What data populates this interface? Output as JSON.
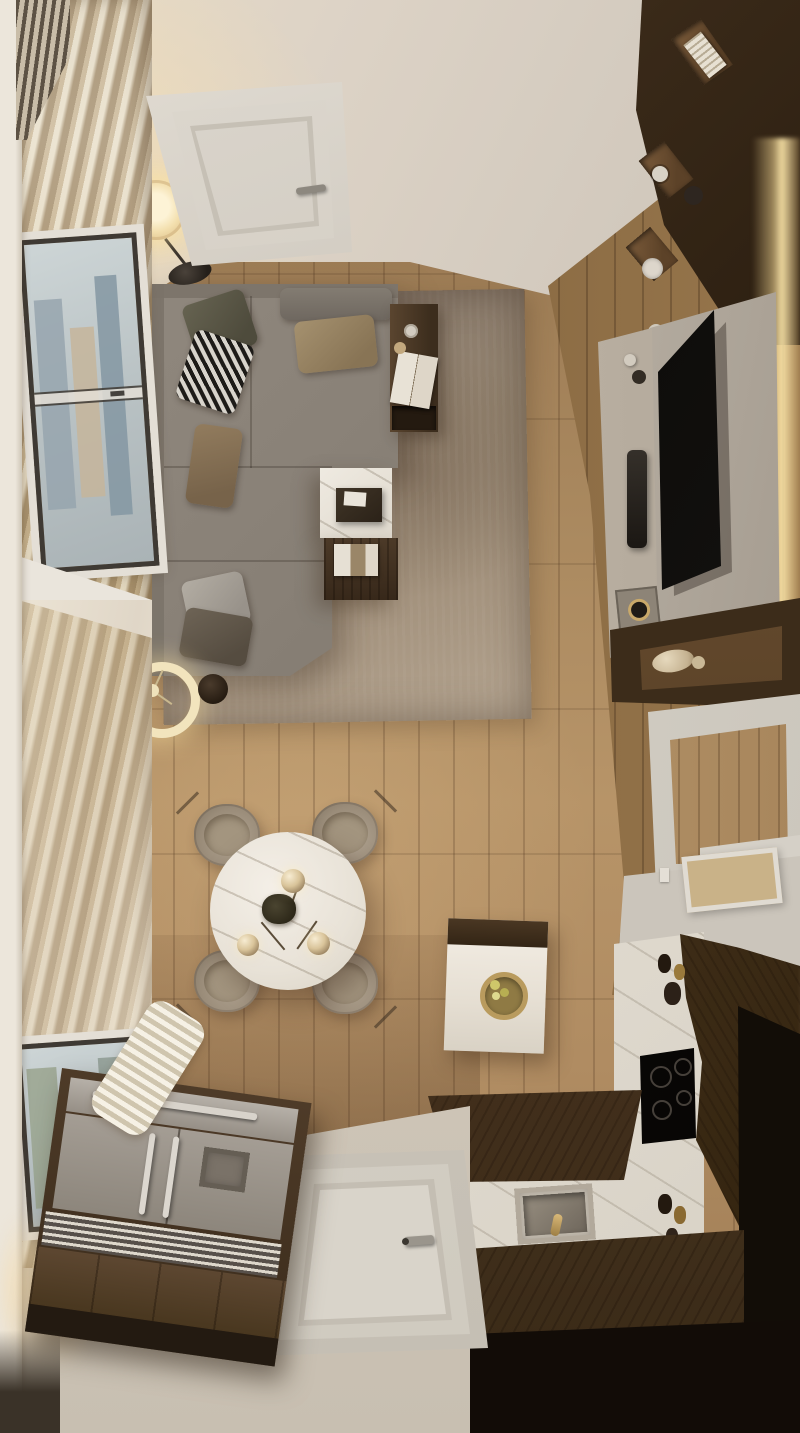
{
  "meta": {
    "domain": "natural-image",
    "subject": "Top-down 3D render of a small apartment: living room with L-shaped sofa, TV wall, round dining table, and walnut-and-marble kitchen",
    "visible_text": []
  },
  "palette": {
    "ceiling": "#d8cfc4",
    "floor-mid": "#a8855c",
    "rug": "#9c8b7a",
    "sofa": "#8a8278",
    "walnut": "#4f3b29",
    "walnut-dark": "#33261a",
    "marble": "#ece7df",
    "tv-black": "#0c0b09",
    "led-glow": "#f3ddad",
    "curtain": "#cbb795",
    "white-door": "#dad5cd",
    "entry-floor": "#cec7bb",
    "steel": "#a49d94",
    "chair": "#a79a8a",
    "gold": "#c9a96a",
    "window-view": "#b9c2c4"
  },
  "scene": {
    "areas": [
      {
        "name": "living-area",
        "objects": [
          "l-shaped-sofa",
          "throw-pillows",
          "area-rug",
          "marble-coffee-table",
          "wood-coffee-table",
          "side-table",
          "floor-lamp",
          "ring-table-lamp"
        ]
      },
      {
        "name": "tv-wall",
        "objects": [
          "bookshelf-cubbies",
          "stone-tv-panel",
          "wall-mounted-tv",
          "soundbar",
          "media-console",
          "floating-shelf",
          "vases",
          "led-strip"
        ]
      },
      {
        "name": "dining-area",
        "objects": [
          "round-marble-table",
          "four-upholstered-chairs",
          "pendant-lamp-three-globes",
          "centerpiece-plant"
        ]
      },
      {
        "name": "kitchen",
        "objects": [
          "marble-countertop",
          "induction-cooktop",
          "stainless-sink",
          "gold-faucet",
          "walnut-cabinets",
          "tall-dark-cabinet",
          "island-with-fruit-bowl",
          "bottles"
        ]
      },
      {
        "name": "entry",
        "objects": [
          "white-entry-door",
          "stainless-fridge-column",
          "vent-grille",
          "beige-floor"
        ]
      },
      {
        "name": "window-side",
        "objects": [
          "sheer-pleated-curtains",
          "city-view-windows",
          "white-wall-strip"
        ]
      },
      {
        "name": "top-wall",
        "objects": [
          "white-interior-door",
          "door-handle"
        ]
      }
    ]
  }
}
